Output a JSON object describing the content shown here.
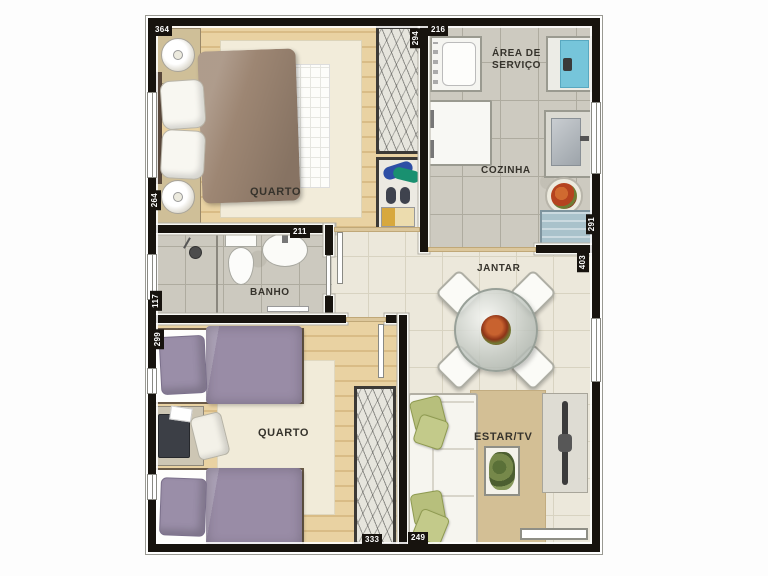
{
  "rooms": {
    "quarto1": "QUARTO",
    "area_servico_l1": "ÁREA DE",
    "area_servico_l2": "SERVIÇO",
    "cozinha": "COZINHA",
    "banho": "BANHO",
    "quarto2": "QUARTO",
    "jantar": "JANTAR",
    "estar": "ESTAR/TV"
  },
  "dimensions": {
    "quarto1_width": "364",
    "quarto1_height": "264",
    "closet1_height": "294",
    "cozinha_width": "216",
    "cozinha_height": "291",
    "jantar_height": "403",
    "banho_width": "211",
    "banho_height": "117",
    "quarto2_height": "299",
    "quarto2_width": "333",
    "sofa_width": "249"
  },
  "colors": {
    "wall": "#17130e",
    "wood_floor": "#e9d2a2",
    "granite_floor": "#ccc9bf",
    "tile_floor": "#ece8db",
    "duvet_brown": "#9d8673",
    "duvet_purple": "#998ca6",
    "pillow_green": "#b7bf7c",
    "rug_beige": "#d3bf95",
    "water_blue": "#76c5da"
  }
}
